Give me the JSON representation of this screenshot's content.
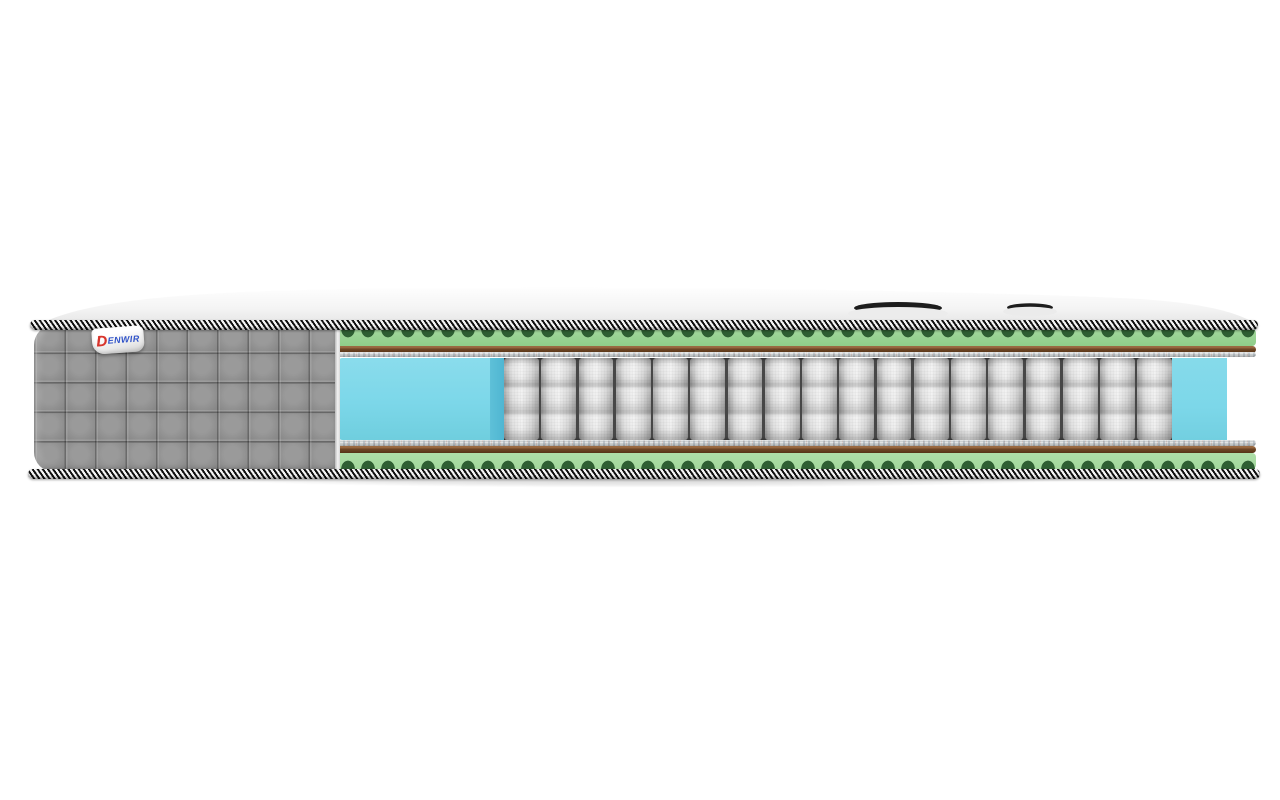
{
  "product": {
    "brand": "DENWIR",
    "logo": {
      "d": "D",
      "rest": "ENWIR"
    }
  },
  "mattress": {
    "view": "cross-section cutaway, side view",
    "handle_count": 2,
    "quilt": {
      "rows": 5,
      "cols": 10
    },
    "core": {
      "spring_count": 18,
      "left_foam_block": true,
      "right_foam_block": true
    },
    "colors": {
      "background": "#ffffff",
      "pillow_white": "#ffffff",
      "pillow_shade": "#e3e3e3",
      "piping_black": "#101010",
      "piping_white": "#f5f5f5",
      "foam_green": "#a2d79c",
      "foam_green_dark": "#2f5f33",
      "felt_brown": "#6e4626",
      "felt_brown_light": "#9a6a42",
      "felt_pad_gray": "#c8cccd",
      "foam_blue": "#7cd7e9",
      "foam_blue_side": "#4fb6d2",
      "spring_light": "#f0f0f0",
      "spring_dark": "#9e9e9e",
      "seam_dark": "#474747",
      "side_gray": "#8f8f8f",
      "handle_dark": "#1d1d1d",
      "logo_red": "#d8342c",
      "logo_blue": "#2f52c8"
    }
  }
}
